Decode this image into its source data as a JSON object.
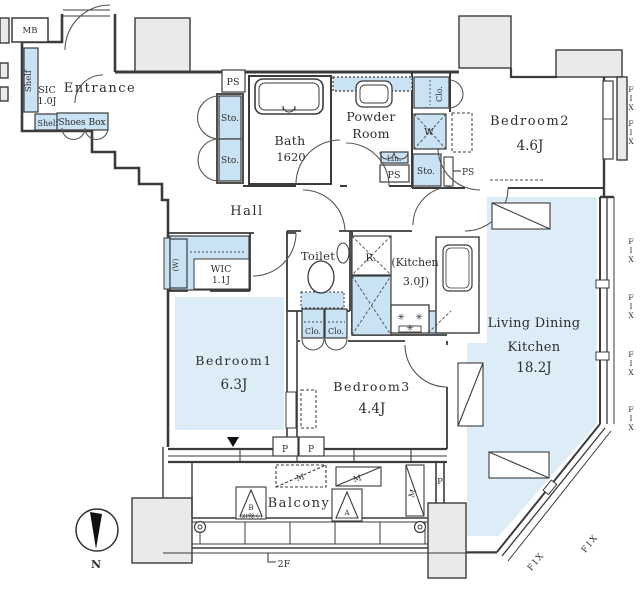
{
  "rooms": {
    "entrance": {
      "name": "Entrance"
    },
    "hall": {
      "name": "Hall"
    },
    "bath": {
      "name": "Bath",
      "size": "1620"
    },
    "powder_room": {
      "line1": "Powder",
      "line2": "Room"
    },
    "toilet": {
      "name": "Toilet"
    },
    "kitchen": {
      "line1": "(Kitchen",
      "line2": "3.0J)"
    },
    "living_dining_kitchen": {
      "line1": "Living Dining",
      "line2": "Kitchen",
      "size": "18.2J"
    },
    "bedroom1": {
      "name": "Bedroom1",
      "size": "6.3J"
    },
    "bedroom2": {
      "name": "Bedroom2",
      "size": "4.6J"
    },
    "bedroom3": {
      "name": "Bedroom3",
      "size": "4.4J"
    },
    "wic": {
      "name": "WIC",
      "size": "1.1J"
    },
    "sic": {
      "name": "SIC",
      "size": "1.0J"
    },
    "balcony": {
      "name": "Balcony"
    }
  },
  "labels": {
    "mb": "MB",
    "shelf": "Shelf",
    "shoes_box": "Shoes Box",
    "storage": "Sto.",
    "closet": "Clo.",
    "linen": "Lin.",
    "pipe_space": "PS",
    "washer": "W",
    "window_mark": "(W)",
    "refrigerator": "R.",
    "pillar": "P",
    "fix_window": "FIX",
    "north": "N",
    "floor_2f": "2F",
    "balcony_m": "M",
    "balcony_a": "A",
    "balcony_b": "B",
    "balcony_b_note": "(2F除く)",
    "burner": "✳"
  },
  "colors": {
    "room_fill": "#ddedf8",
    "cabinet_fill": "#c9e3f4",
    "wall": "#3b3b3b",
    "block_fill": "#e9eaec"
  }
}
